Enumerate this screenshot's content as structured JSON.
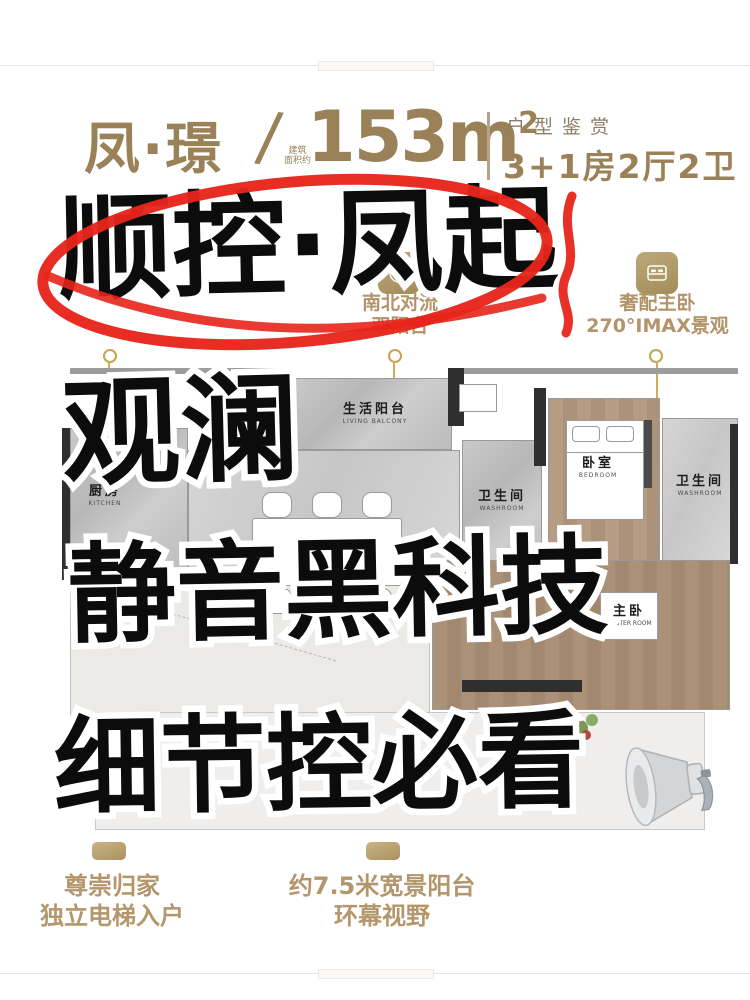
{
  "header": {
    "brand": "凤·璟",
    "slash": "/",
    "area_note_line1": "建筑",
    "area_note_line2": "面积约",
    "area_value": "153m",
    "area_sup": "2",
    "section_label": "户型鉴赏",
    "layout_spec": "3+1房2厅2卫"
  },
  "mid_callouts": {
    "center": {
      "icon": "compass-flower-icon",
      "line1": "南北对流",
      "line2": "双阳台"
    },
    "right": {
      "icon": "bed-icon",
      "line1": "奢配主卧",
      "line2": "270°IMAX景观"
    }
  },
  "floorplan": {
    "rooms": [
      {
        "name_cn": "生活阳台",
        "name_en": "LIVING BALCONY"
      },
      {
        "name_cn": "厨房",
        "name_en": "KITCHEN"
      },
      {
        "name_cn": "餐厅",
        "name_en": "DINING ROOM"
      },
      {
        "name_cn": "卫生间",
        "name_en": "WASHROOM"
      },
      {
        "name_cn": "卧室",
        "name_en": "BEDROOM"
      },
      {
        "name_cn": "卫生间",
        "name_en": "WASHROOM"
      },
      {
        "name_cn": "主卧",
        "name_en": "MASTER ROOM"
      }
    ]
  },
  "overlay": {
    "line1": "顺控·凤起",
    "line2": "观澜",
    "line3": "静音黑科技",
    "line4": "细节控必看",
    "megaphone": "megaphone-icon",
    "circle_color": "#e7251b",
    "ink_color": "#0c0c0c"
  },
  "bottom_callouts": {
    "left": {
      "line1": "尊崇归家",
      "line2": "独立电梯入户"
    },
    "right": {
      "line1": "约7.5米宽景阳台",
      "line2": "环幕视野"
    }
  },
  "colors": {
    "bronze": "#9a8158",
    "gold": "#b5a06e",
    "red": "#e7251b"
  }
}
